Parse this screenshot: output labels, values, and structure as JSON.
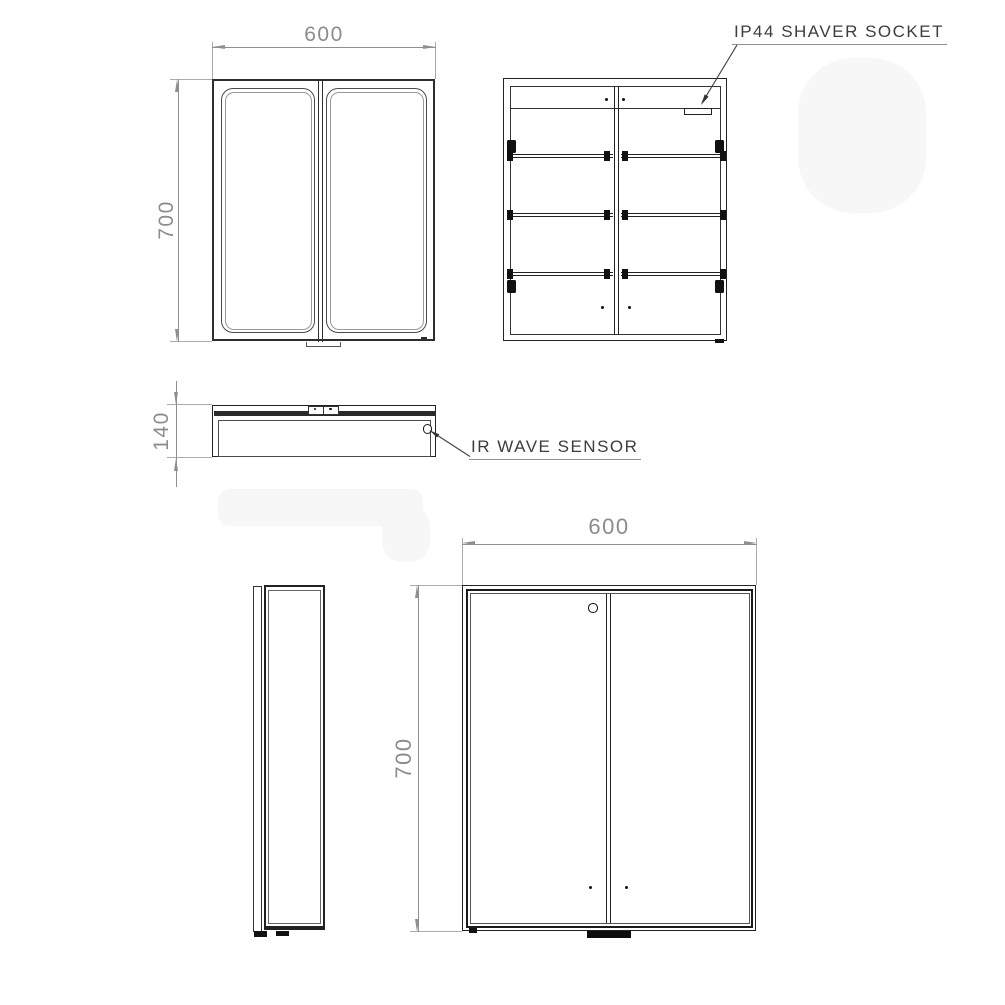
{
  "views": {
    "front": {
      "width_label": "600",
      "height_label": "700"
    },
    "internal": {
      "socket_label": "IP44 SHAVER SOCKET"
    },
    "bottom": {
      "depth_label": "140",
      "sensor_label": "IR WAVE SENSOR"
    },
    "rear": {
      "width_label": "600",
      "height_label": "700"
    }
  },
  "colors": {
    "background": "#ffffff",
    "main_lines": "#222222",
    "dimension_lines": "#8f8f8f",
    "annotation_text": "#3d3d3d"
  }
}
